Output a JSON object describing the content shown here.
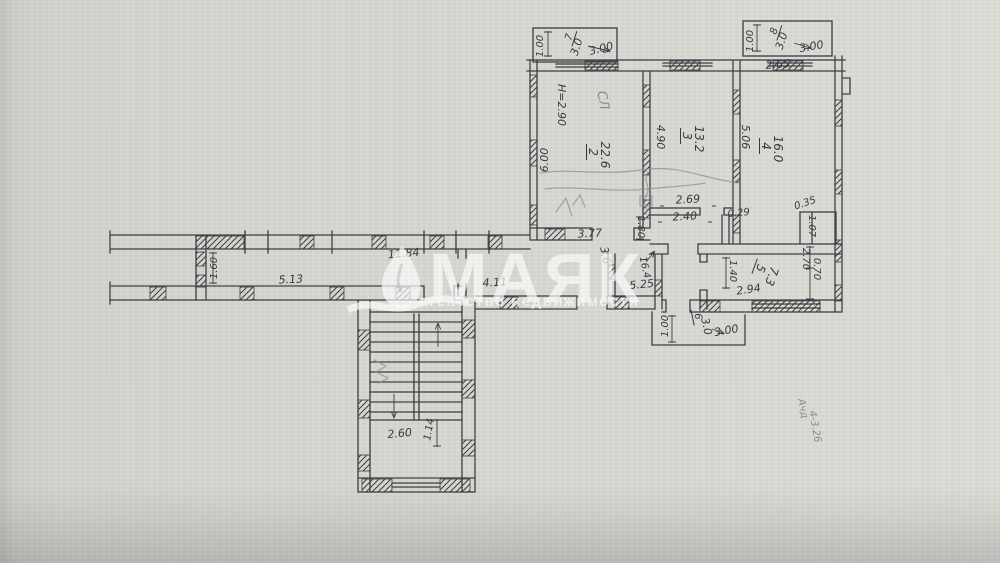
{
  "watermark": {
    "brand": "МАЯК",
    "subtitle": "агентство недвижимости"
  },
  "plan": {
    "ceiling_height_note": "H=2.90",
    "rooms": [
      {
        "number": "2",
        "area": "22.6"
      },
      {
        "number": "3",
        "area": "13.2"
      },
      {
        "number": "4",
        "area": "16.0"
      },
      {
        "number": "5",
        "area": "7.3"
      },
      {
        "number": "6",
        "area": "3.0"
      },
      {
        "number": "7",
        "area": "3.0"
      },
      {
        "number": "8",
        "area": "3.0"
      }
    ],
    "labels": [
      {
        "t": "1.00",
        "x": 543,
        "y": 46,
        "r": -90,
        "s": 10
      },
      {
        "t": "7",
        "x": 572,
        "y": 38,
        "r": -72,
        "s": 10,
        "ul": true
      },
      {
        "t": "3.0",
        "x": 580,
        "y": 48,
        "r": -72,
        "s": 11
      },
      {
        "t": "3.00",
        "x": 602,
        "y": 52,
        "r": -14,
        "s": 11
      },
      {
        "t": "1.00",
        "x": 753,
        "y": 41,
        "r": -90,
        "s": 10
      },
      {
        "t": "8",
        "x": 777,
        "y": 32,
        "r": -72,
        "s": 10,
        "ul": true
      },
      {
        "t": "3.0",
        "x": 785,
        "y": 42,
        "r": -72,
        "s": 11
      },
      {
        "t": "3.00",
        "x": 812,
        "y": 50,
        "r": -10,
        "s": 11
      },
      {
        "t": "2.65",
        "x": 778,
        "y": 68,
        "r": -4,
        "s": 11
      },
      {
        "t": "H=2.90",
        "x": 558,
        "y": 105,
        "r": 90,
        "s": 11
      },
      {
        "t": "СЛ",
        "x": 599,
        "y": 101,
        "r": 80,
        "s": 13,
        "cls": "pencil",
        "n": "pencil-note"
      },
      {
        "t": "6.00",
        "x": 548,
        "y": 160,
        "r": -90,
        "s": 11
      },
      {
        "t": "2",
        "x": 589,
        "y": 152,
        "r": 90,
        "s": 12,
        "ul": true
      },
      {
        "t": "22.6",
        "x": 601,
        "y": 155,
        "r": 90,
        "s": 12
      },
      {
        "t": "4.90",
        "x": 657,
        "y": 137,
        "r": 90,
        "s": 11
      },
      {
        "t": "3",
        "x": 683,
        "y": 136,
        "r": 90,
        "s": 12,
        "ul": true
      },
      {
        "t": "13.2",
        "x": 695,
        "y": 139,
        "r": 90,
        "s": 12
      },
      {
        "t": "5.06",
        "x": 742,
        "y": 137,
        "r": 90,
        "s": 11
      },
      {
        "t": "4",
        "x": 762,
        "y": 146,
        "r": 90,
        "s": 12,
        "ul": true
      },
      {
        "t": "16.0",
        "x": 774,
        "y": 149,
        "r": 90,
        "s": 12
      },
      {
        "t": "2.69",
        "x": 688,
        "y": 203,
        "r": -3,
        "s": 11
      },
      {
        "t": "2.40",
        "x": 685,
        "y": 220,
        "r": -3,
        "s": 11
      },
      {
        "t": "1.80",
        "x": 638,
        "y": 227,
        "r": 90,
        "s": 10
      },
      {
        "t": "0.29",
        "x": 739,
        "y": 216,
        "r": -6,
        "s": 10
      },
      {
        "t": "0.35",
        "x": 806,
        "y": 206,
        "r": -18,
        "s": 10
      },
      {
        "t": "1.07",
        "x": 809,
        "y": 226,
        "r": 90,
        "s": 10
      },
      {
        "t": "3.77",
        "x": 590,
        "y": 237,
        "r": -3,
        "s": 11
      },
      {
        "t": "11.84",
        "x": 404,
        "y": 257,
        "r": -5,
        "s": 11
      },
      {
        "t": "1.60",
        "x": 217,
        "y": 268,
        "r": -90,
        "s": 10
      },
      {
        "t": "5.13",
        "x": 291,
        "y": 283,
        "r": -3,
        "s": 11
      },
      {
        "t": "4.11",
        "x": 495,
        "y": 286,
        "r": -3,
        "s": 11
      },
      {
        "t": "3.6",
        "x": 602,
        "y": 256,
        "r": 78,
        "s": 11
      },
      {
        "t": "16.4",
        "x": 642,
        "y": 268,
        "r": 78,
        "s": 10
      },
      {
        "t": "5.25",
        "x": 642,
        "y": 288,
        "r": -5,
        "s": 11
      },
      {
        "t": "1.40",
        "x": 730,
        "y": 271,
        "r": 90,
        "s": 10
      },
      {
        "t": "5",
        "x": 757,
        "y": 267,
        "r": 110,
        "s": 12,
        "ul": true
      },
      {
        "t": "7.3",
        "x": 768,
        "y": 275,
        "r": 110,
        "s": 12
      },
      {
        "t": "2.94",
        "x": 749,
        "y": 293,
        "r": -8,
        "s": 11
      },
      {
        "t": "2.70",
        "x": 803,
        "y": 259,
        "r": 90,
        "s": 10
      },
      {
        "t": "0.70",
        "x": 814,
        "y": 269,
        "r": 90,
        "s": 10
      },
      {
        "t": "1.00",
        "x": 668,
        "y": 326,
        "r": -90,
        "s": 10
      },
      {
        "t": "6",
        "x": 695,
        "y": 317,
        "r": 78,
        "s": 10,
        "ul": true
      },
      {
        "t": "3.0",
        "x": 703,
        "y": 327,
        "r": 78,
        "s": 11
      },
      {
        "t": "3.00",
        "x": 727,
        "y": 334,
        "r": -10,
        "s": 11
      },
      {
        "t": "2.60",
        "x": 400,
        "y": 437,
        "r": -5,
        "s": 11
      },
      {
        "t": "1.14",
        "x": 432,
        "y": 430,
        "r": -80,
        "s": 10
      },
      {
        "t": "Ачд",
        "x": 800,
        "y": 409,
        "r": 80,
        "s": 10,
        "cls": "pencil",
        "n": "handwritten-note"
      },
      {
        "t": "4-3.26",
        "x": 812,
        "y": 427,
        "r": 80,
        "s": 10,
        "cls": "pencil",
        "n": "handwritten-note"
      }
    ]
  }
}
